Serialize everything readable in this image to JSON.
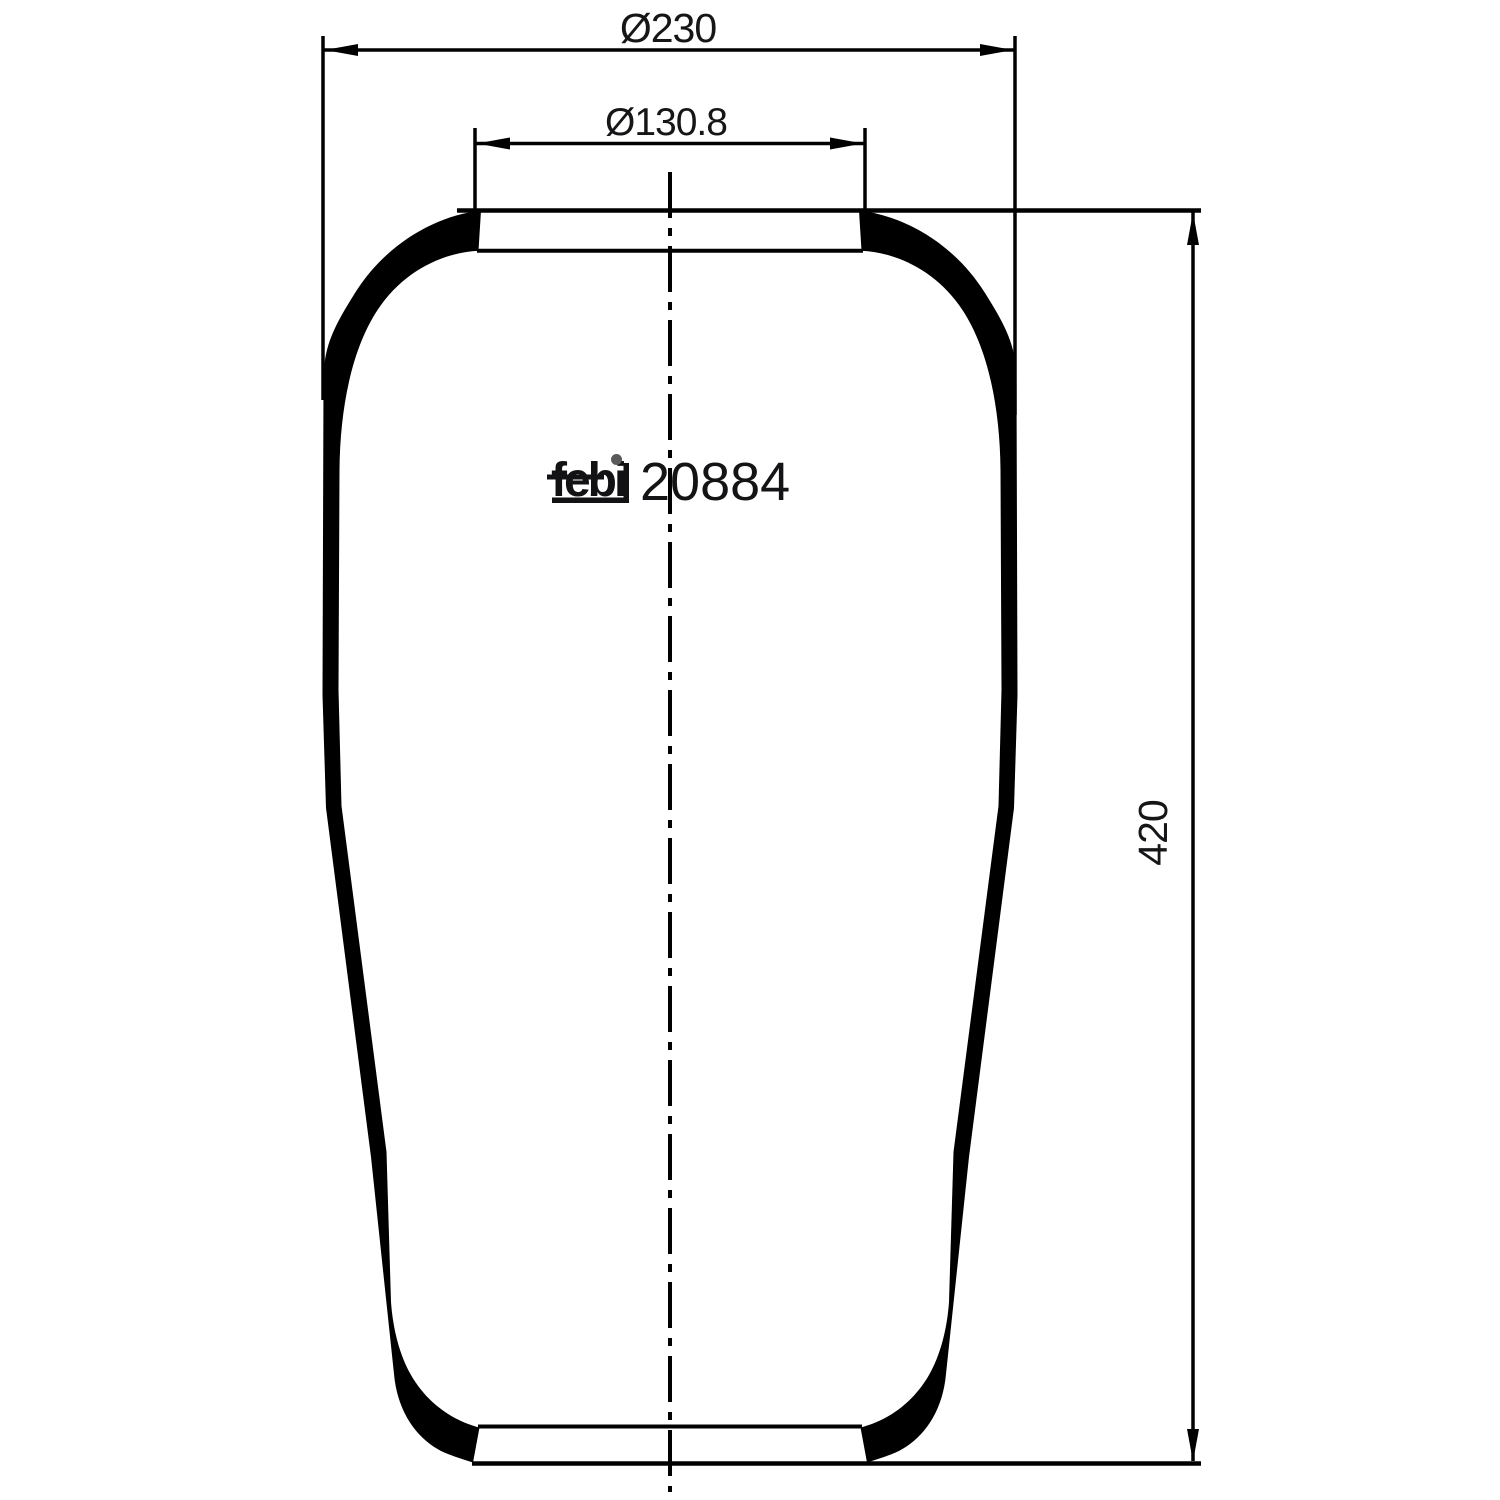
{
  "drawing": {
    "type": "technical-drawing",
    "subject": "air spring bellows side profile",
    "brand_logo": "febi",
    "part_number": "20884",
    "dimensions": {
      "outer_diameter_label": "Ø230",
      "neck_diameter_label": "Ø130.8",
      "height_label": "420"
    },
    "colors": {
      "ink": "#000000",
      "background": "#ffffff",
      "text": "#161618",
      "logo_dot": "#5a5a5a"
    }
  }
}
